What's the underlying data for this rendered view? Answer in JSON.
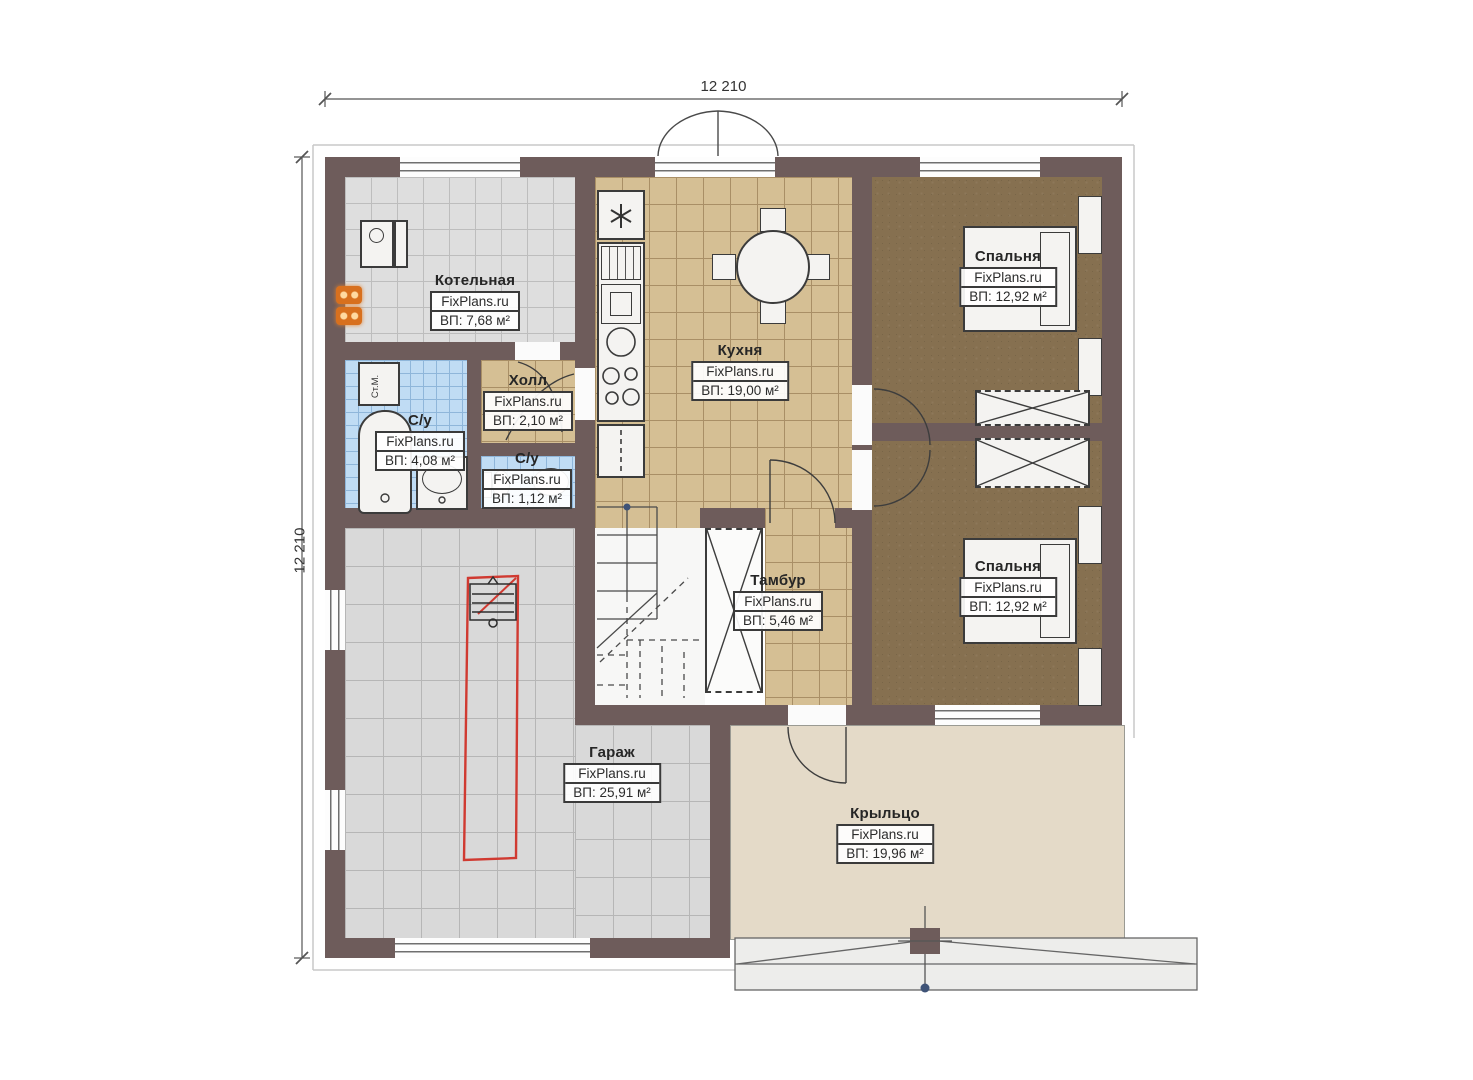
{
  "brand": "FixPlans.ru",
  "dimensions": {
    "top": "12 210",
    "left": "12 210"
  },
  "rooms": [
    {
      "id": "boiler",
      "name": "Котельная",
      "brand": "FixPlans.ru",
      "area": "ВП: 7,68 м²"
    },
    {
      "id": "bath1",
      "name": "С/у",
      "brand": "FixPlans.ru",
      "area": "ВП: 4,08 м²"
    },
    {
      "id": "hall",
      "name": "Холл",
      "brand": "FixPlans.ru",
      "area": "ВП: 2,10 м²"
    },
    {
      "id": "bath2",
      "name": "С/у",
      "brand": "FixPlans.ru",
      "area": "ВП: 1,12 м²"
    },
    {
      "id": "kitchen",
      "name": "Кухня",
      "brand": "FixPlans.ru",
      "area": "ВП: 19,00 м²"
    },
    {
      "id": "bedroom1",
      "name": "Спальня",
      "brand": "FixPlans.ru",
      "area": "ВП: 12,92 м²"
    },
    {
      "id": "bedroom2",
      "name": "Спальня",
      "brand": "FixPlans.ru",
      "area": "ВП: 12,92 м²"
    },
    {
      "id": "tambour",
      "name": "Тамбур",
      "brand": "FixPlans.ru",
      "area": "ВП: 5,46 м²"
    },
    {
      "id": "garage",
      "name": "Гараж",
      "brand": "FixPlans.ru",
      "area": "ВП: 25,91 м²"
    },
    {
      "id": "porch",
      "name": "Крыльцо",
      "brand": "FixPlans.ru",
      "area": "ВП: 19,96 м²"
    }
  ],
  "fixtures": {
    "washing_machine": "Ст.М."
  },
  "colors": {
    "wall": "#6e5c5b",
    "tile_gray": "#dedede",
    "tile_tan": "#d5bf94",
    "tile_blue": "#c0dcf4",
    "bedroom_floor": "#867050",
    "porch_floor": "#e4dac8",
    "parking_outline": "#d03a31"
  }
}
